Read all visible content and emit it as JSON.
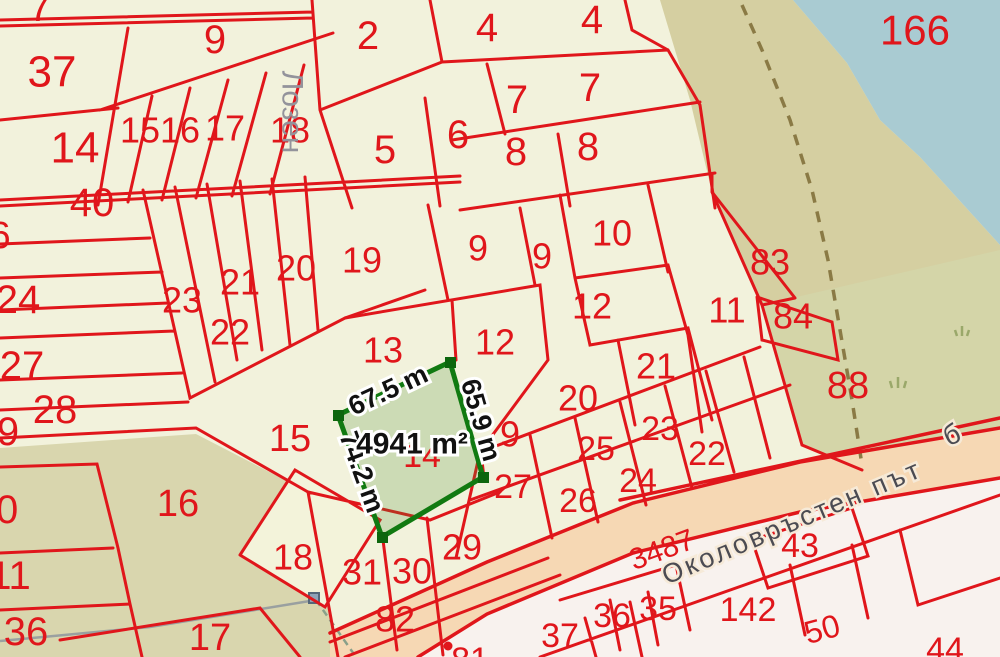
{
  "map": {
    "type": "cadastral-parcel-map",
    "colors": {
      "background_parcel": "#f2f2dc",
      "boundary_red": "#e0161b",
      "parcel_number_red": "#e0161b",
      "water_blue": "#a9cbd2",
      "shore_tan": "#d5cfa1",
      "vegetation_olive": "#d9d6ae",
      "meadow_green": "#d4d5a8",
      "road_fill": "#f6d8b4",
      "below_road_fill": "#f8f2ee",
      "highlight_border_green": "#117a11",
      "highlight_fill_green": "#d1ddb8",
      "measurement_text": "#111111",
      "road_text_gray": "#4b4b52",
      "place_text_gray": "#93939b",
      "survey_path_gray": "#9aa0a0",
      "trail_dashed_brown": "#8a7a45"
    },
    "highlighted_parcel": {
      "area_label": "4941 m²",
      "hidden_parcel_number": "14",
      "side_measurements": [
        "67.5 m",
        "65.9 m",
        "74.2 m"
      ]
    },
    "place_label": "Лозен",
    "road_label": "Околовръстен път",
    "water_parcel_label": "166",
    "labels": [
      {
        "t": "7",
        "x": 40,
        "y": 8,
        "s": 40,
        "c": "red"
      },
      {
        "t": "37",
        "x": 52,
        "y": 72,
        "s": 44,
        "c": "red"
      },
      {
        "t": "9",
        "x": 215,
        "y": 40,
        "s": 40,
        "c": "red"
      },
      {
        "t": "2",
        "x": 368,
        "y": 36,
        "s": 40,
        "c": "red"
      },
      {
        "t": "4",
        "x": 487,
        "y": 28,
        "s": 40,
        "c": "red"
      },
      {
        "t": "4",
        "x": 592,
        "y": 20,
        "s": 40,
        "c": "red"
      },
      {
        "t": "7",
        "x": 517,
        "y": 100,
        "s": 40,
        "c": "red"
      },
      {
        "t": "7",
        "x": 590,
        "y": 88,
        "s": 40,
        "c": "red"
      },
      {
        "t": "5",
        "x": 385,
        "y": 150,
        "s": 40,
        "c": "red"
      },
      {
        "t": "6",
        "x": 458,
        "y": 135,
        "s": 40,
        "c": "red"
      },
      {
        "t": "8",
        "x": 516,
        "y": 152,
        "s": 40,
        "c": "red"
      },
      {
        "t": "8",
        "x": 588,
        "y": 147,
        "s": 40,
        "c": "red"
      },
      {
        "t": "14",
        "x": 75,
        "y": 148,
        "s": 44,
        "c": "red"
      },
      {
        "t": "40",
        "x": 92,
        "y": 203,
        "s": 40,
        "c": "red"
      },
      {
        "t": "15",
        "x": 140,
        "y": 130,
        "s": 36,
        "c": "red"
      },
      {
        "t": "16",
        "x": 180,
        "y": 130,
        "s": 36,
        "c": "red"
      },
      {
        "t": "17",
        "x": 225,
        "y": 128,
        "s": 36,
        "c": "red"
      },
      {
        "t": "18",
        "x": 290,
        "y": 130,
        "s": 36,
        "c": "red"
      },
      {
        "t": "6",
        "x": 0,
        "y": 236,
        "s": 38,
        "c": "red"
      },
      {
        "t": "24",
        "x": 18,
        "y": 300,
        "s": 40,
        "c": "red"
      },
      {
        "t": "27",
        "x": 22,
        "y": 366,
        "s": 40,
        "c": "red"
      },
      {
        "t": "28",
        "x": 55,
        "y": 410,
        "s": 40,
        "c": "red"
      },
      {
        "t": "9",
        "x": 8,
        "y": 432,
        "s": 40,
        "c": "red"
      },
      {
        "t": "10",
        "x": -4,
        "y": 510,
        "s": 40,
        "c": "red"
      },
      {
        "t": "11",
        "x": 10,
        "y": 576,
        "s": 40,
        "c": "red"
      },
      {
        "t": "36",
        "x": 26,
        "y": 632,
        "s": 40,
        "c": "red"
      },
      {
        "t": "20",
        "x": 296,
        "y": 268,
        "s": 36,
        "c": "red"
      },
      {
        "t": "21",
        "x": 240,
        "y": 282,
        "s": 36,
        "c": "red"
      },
      {
        "t": "23",
        "x": 182,
        "y": 300,
        "s": 36,
        "c": "red"
      },
      {
        "t": "22",
        "x": 230,
        "y": 332,
        "s": 36,
        "c": "red"
      },
      {
        "t": "19",
        "x": 362,
        "y": 260,
        "s": 36,
        "c": "red"
      },
      {
        "t": "9",
        "x": 478,
        "y": 248,
        "s": 36,
        "c": "red"
      },
      {
        "t": "9",
        "x": 542,
        "y": 256,
        "s": 36,
        "c": "red"
      },
      {
        "t": "10",
        "x": 612,
        "y": 233,
        "s": 36,
        "c": "red"
      },
      {
        "t": "12",
        "x": 592,
        "y": 306,
        "s": 36,
        "c": "red"
      },
      {
        "t": "11",
        "x": 727,
        "y": 310,
        "s": 36,
        "c": "red"
      },
      {
        "t": "83",
        "x": 770,
        "y": 262,
        "s": 36,
        "c": "red"
      },
      {
        "t": "84",
        "x": 793,
        "y": 316,
        "s": 36,
        "c": "red"
      },
      {
        "t": "13",
        "x": 383,
        "y": 350,
        "s": 36,
        "c": "red"
      },
      {
        "t": "12",
        "x": 495,
        "y": 342,
        "s": 36,
        "c": "red"
      },
      {
        "t": "21",
        "x": 656,
        "y": 366,
        "s": 36,
        "c": "red"
      },
      {
        "t": "88",
        "x": 848,
        "y": 386,
        "s": 38,
        "c": "red"
      },
      {
        "t": "20",
        "x": 578,
        "y": 398,
        "s": 36,
        "c": "red"
      },
      {
        "t": "9",
        "x": 510,
        "y": 434,
        "s": 36,
        "c": "red"
      },
      {
        "t": "25",
        "x": 596,
        "y": 449,
        "s": 34,
        "c": "red"
      },
      {
        "t": "23",
        "x": 660,
        "y": 429,
        "s": 34,
        "c": "red"
      },
      {
        "t": "22",
        "x": 707,
        "y": 454,
        "s": 34,
        "c": "red"
      },
      {
        "t": "24",
        "x": 638,
        "y": 481,
        "s": 34,
        "c": "red"
      },
      {
        "t": "26",
        "x": 578,
        "y": 501,
        "s": 34,
        "c": "red"
      },
      {
        "t": "27",
        "x": 513,
        "y": 487,
        "s": 34,
        "c": "red"
      },
      {
        "t": "15",
        "x": 290,
        "y": 439,
        "s": 38,
        "c": "red"
      },
      {
        "t": "16",
        "x": 178,
        "y": 504,
        "s": 38,
        "c": "red"
      },
      {
        "t": "18",
        "x": 293,
        "y": 557,
        "s": 36,
        "c": "red"
      },
      {
        "t": "17",
        "x": 210,
        "y": 638,
        "s": 38,
        "c": "red"
      },
      {
        "t": "31",
        "x": 362,
        "y": 572,
        "s": 36,
        "c": "red"
      },
      {
        "t": "30",
        "x": 412,
        "y": 571,
        "s": 36,
        "c": "red"
      },
      {
        "t": "82",
        "x": 395,
        "y": 619,
        "s": 36,
        "c": "red"
      },
      {
        "t": "29",
        "x": 462,
        "y": 547,
        "s": 36,
        "c": "red"
      },
      {
        "t": "14",
        "x": 422,
        "y": 456,
        "s": 34,
        "c": "red"
      },
      {
        "t": "3487",
        "x": 662,
        "y": 550,
        "s": 30,
        "r": -20,
        "c": "red"
      },
      {
        "t": "43",
        "x": 800,
        "y": 546,
        "s": 34,
        "c": "red"
      },
      {
        "t": "37",
        "x": 560,
        "y": 636,
        "s": 34,
        "c": "red"
      },
      {
        "t": "36",
        "x": 612,
        "y": 616,
        "s": 34,
        "c": "red"
      },
      {
        "t": "35",
        "x": 658,
        "y": 609,
        "s": 34,
        "c": "red"
      },
      {
        "t": "142",
        "x": 748,
        "y": 610,
        "s": 34,
        "c": "red"
      },
      {
        "t": "50",
        "x": 822,
        "y": 629,
        "s": 32,
        "r": -15,
        "c": "red"
      },
      {
        "t": "44",
        "x": 945,
        "y": 650,
        "s": 34,
        "c": "red"
      },
      {
        "t": "81",
        "x": 470,
        "y": 660,
        "s": 34,
        "c": "red"
      },
      {
        "t": "166",
        "x": 915,
        "y": 30,
        "s": 42,
        "c": "red"
      },
      {
        "t": "67.5 m",
        "x": 388,
        "y": 390,
        "s": 27,
        "r": -25,
        "c": "meas"
      },
      {
        "t": "65.9 m",
        "x": 481,
        "y": 420,
        "s": 27,
        "r": 74,
        "c": "meas"
      },
      {
        "t": "74.2 m",
        "x": 362,
        "y": 472,
        "s": 27,
        "r": 70,
        "c": "meas"
      },
      {
        "t": "4941 m²",
        "x": 412,
        "y": 444,
        "s": 30,
        "r": 0,
        "c": "meas"
      },
      {
        "t": "Лозен",
        "x": 292,
        "y": 112,
        "s": 30,
        "r": 90,
        "c": "gray"
      },
      {
        "t": "Околовръстен път",
        "x": 792,
        "y": 522,
        "s": 27,
        "r": -23,
        "c": "road"
      },
      {
        "t": "б",
        "x": 953,
        "y": 434,
        "s": 28,
        "r": -25,
        "c": "road"
      }
    ]
  }
}
